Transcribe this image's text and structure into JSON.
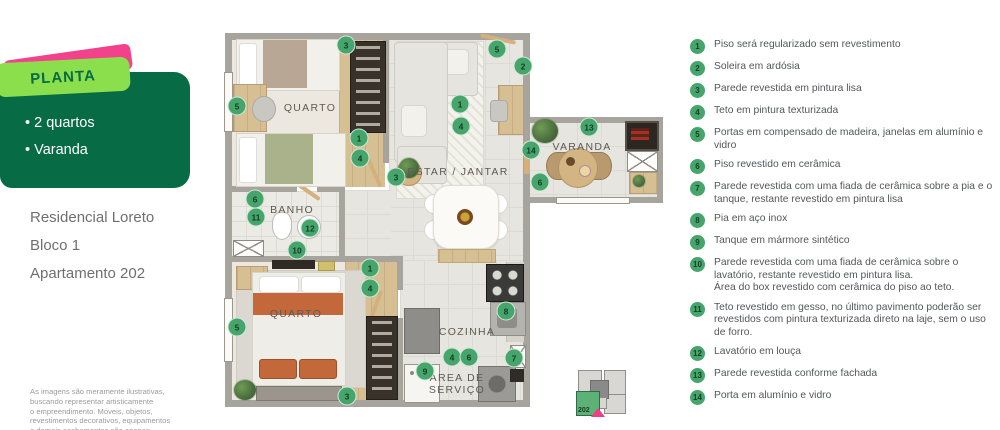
{
  "colors": {
    "brand_dark_green": "#076b46",
    "brand_light_green": "#8bdf4d",
    "brand_pink": "#f4418b",
    "marker_green": "#46a56a"
  },
  "panel": {
    "badge": "PLANTA",
    "features": [
      {
        "text": "2 quartos"
      },
      {
        "text": "Varanda"
      }
    ],
    "building": [
      {
        "text": "Residencial Loreto"
      },
      {
        "text": "Bloco 1"
      },
      {
        "text": "Apartamento 202"
      }
    ],
    "disclaimer": "As imagens são meramente ilustrativas,\nbuscando representar artisticamente\no empreendimento. Móveis, objetos,\nrevestimentos decorativos, equipamentos\ne demais acabamentos são apenas"
  },
  "plan": {
    "labels": [
      {
        "text": "QUARTO",
        "x": 310,
        "y": 108
      },
      {
        "text": "ESTAR / JANTAR",
        "x": 458,
        "y": 172
      },
      {
        "text": "VARANDA",
        "x": 582,
        "y": 147
      },
      {
        "text": "BANHO",
        "x": 292,
        "y": 210
      },
      {
        "text": "QUARTO",
        "x": 296,
        "y": 314
      },
      {
        "text": "COZINHA",
        "x": 467,
        "y": 332
      },
      {
        "text": "ÁREA DE\nSERVIÇO",
        "x": 457,
        "y": 384
      }
    ],
    "markers": [
      {
        "n": "3",
        "x": 346,
        "y": 45
      },
      {
        "n": "5",
        "x": 497,
        "y": 49
      },
      {
        "n": "2",
        "x": 523,
        "y": 66
      },
      {
        "n": "5",
        "x": 237,
        "y": 106
      },
      {
        "n": "1",
        "x": 460,
        "y": 104
      },
      {
        "n": "4",
        "x": 461,
        "y": 126
      },
      {
        "n": "1",
        "x": 359,
        "y": 138
      },
      {
        "n": "4",
        "x": 360,
        "y": 158
      },
      {
        "n": "3",
        "x": 396,
        "y": 177
      },
      {
        "n": "13",
        "x": 589,
        "y": 127
      },
      {
        "n": "14",
        "x": 531,
        "y": 150
      },
      {
        "n": "6",
        "x": 540,
        "y": 182
      },
      {
        "n": "6",
        "x": 255,
        "y": 199
      },
      {
        "n": "11",
        "x": 256,
        "y": 217
      },
      {
        "n": "12",
        "x": 310,
        "y": 228
      },
      {
        "n": "10",
        "x": 297,
        "y": 250
      },
      {
        "n": "1",
        "x": 370,
        "y": 268
      },
      {
        "n": "4",
        "x": 370,
        "y": 288
      },
      {
        "n": "5",
        "x": 237,
        "y": 327
      },
      {
        "n": "8",
        "x": 506,
        "y": 311
      },
      {
        "n": "4",
        "x": 452,
        "y": 357
      },
      {
        "n": "6",
        "x": 469,
        "y": 357
      },
      {
        "n": "7",
        "x": 514,
        "y": 358
      },
      {
        "n": "9",
        "x": 425,
        "y": 371
      },
      {
        "n": "3",
        "x": 347,
        "y": 396
      }
    ],
    "keyplan": {
      "unit": "202"
    }
  },
  "legend": {
    "items": [
      {
        "n": "1",
        "text": "Piso será regularizado sem revestimento"
      },
      {
        "n": "2",
        "text": "Soleira em ardósia"
      },
      {
        "n": "3",
        "text": "Parede revestida em pintura lisa"
      },
      {
        "n": "4",
        "text": "Teto em pintura texturizada"
      },
      {
        "n": "5",
        "text": "Portas em compensado de madeira, janelas em alumínio e vidro"
      },
      {
        "n": "6",
        "text": "Piso revestido em cerâmica"
      },
      {
        "n": "7",
        "text": "Parede revestida com uma fiada de cerâmica sobre a pia e o tanque, restante revestido em pintura lisa"
      },
      {
        "n": "8",
        "text": "Pia em aço inox"
      },
      {
        "n": "9",
        "text": "Tanque em mármore sintético"
      },
      {
        "n": "10",
        "text": "Parede revestida com uma fiada de cerâmica sobre o lavatório, restante revestido em pintura lisa.\nÁrea do box revestido com cerâmica do piso ao teto."
      },
      {
        "n": "11",
        "text": "Teto revestido em gesso, no último pavimento poderão ser revestidos com pintura texturizada direto na laje, sem o uso de forro."
      },
      {
        "n": "12",
        "text": "Lavatório em louça"
      },
      {
        "n": "13",
        "text": "Parede revestida conforme fachada"
      },
      {
        "n": "14",
        "text": "Porta em alumínio e vidro"
      }
    ]
  }
}
